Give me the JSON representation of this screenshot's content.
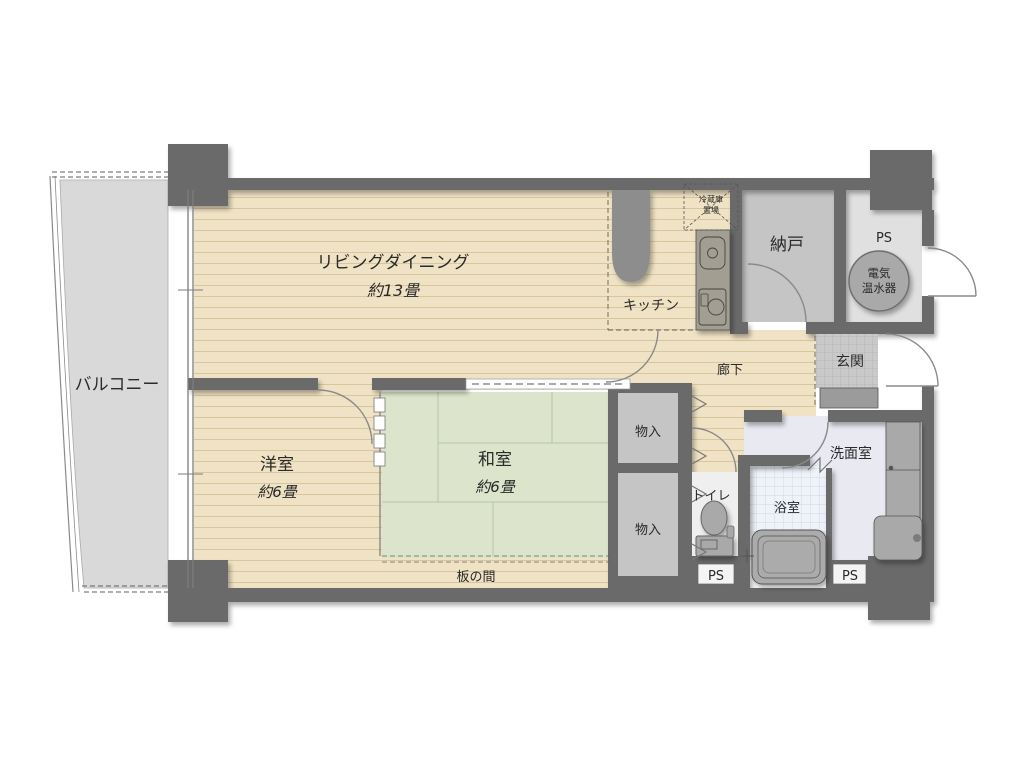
{
  "plan": {
    "rooms": {
      "balcony": "バルコニー",
      "living_dining": {
        "name": "リビングダイニング",
        "size": "約13畳"
      },
      "kitchen": "キッチン",
      "pantry": "納戸",
      "entrance": "玄関",
      "corridor": "廊下",
      "western_room": {
        "name": "洋室",
        "size": "約6畳"
      },
      "japanese_room": {
        "name": "和室",
        "size": "約6畳"
      },
      "itanoma": "板の間",
      "closet": "物入",
      "toilet": "トイレ",
      "bath": "浴室",
      "washroom": "洗面室"
    },
    "labels": {
      "ps": "PS",
      "water_heater": {
        "line1": "電気",
        "line2": "温水器"
      },
      "fridge": {
        "line1": "冷蔵庫",
        "line2": "置場"
      }
    },
    "colors": {
      "wall": "#6a6a6a",
      "wood": "#f0e3c5",
      "wood_line": "#d8c69e",
      "tatami": "#dce4cb",
      "tatami_line": "#b7c4a5",
      "balcony": "#d9d9d9",
      "service": "#c5c5c5",
      "ps_floor": "#e0e0e0",
      "tile": "#c9c9c9",
      "tile_line": "#b0b0b0",
      "wash_floor": "#e9e9f2",
      "bath_floor": "#eef3f9",
      "bath_line": "#ccd9e6",
      "toilet_floor": "#efefef",
      "ps_box": "#f4f4f4",
      "fixture": "#a9a9a9",
      "counter": "#a39e92",
      "text": "#2a2a2a"
    }
  }
}
